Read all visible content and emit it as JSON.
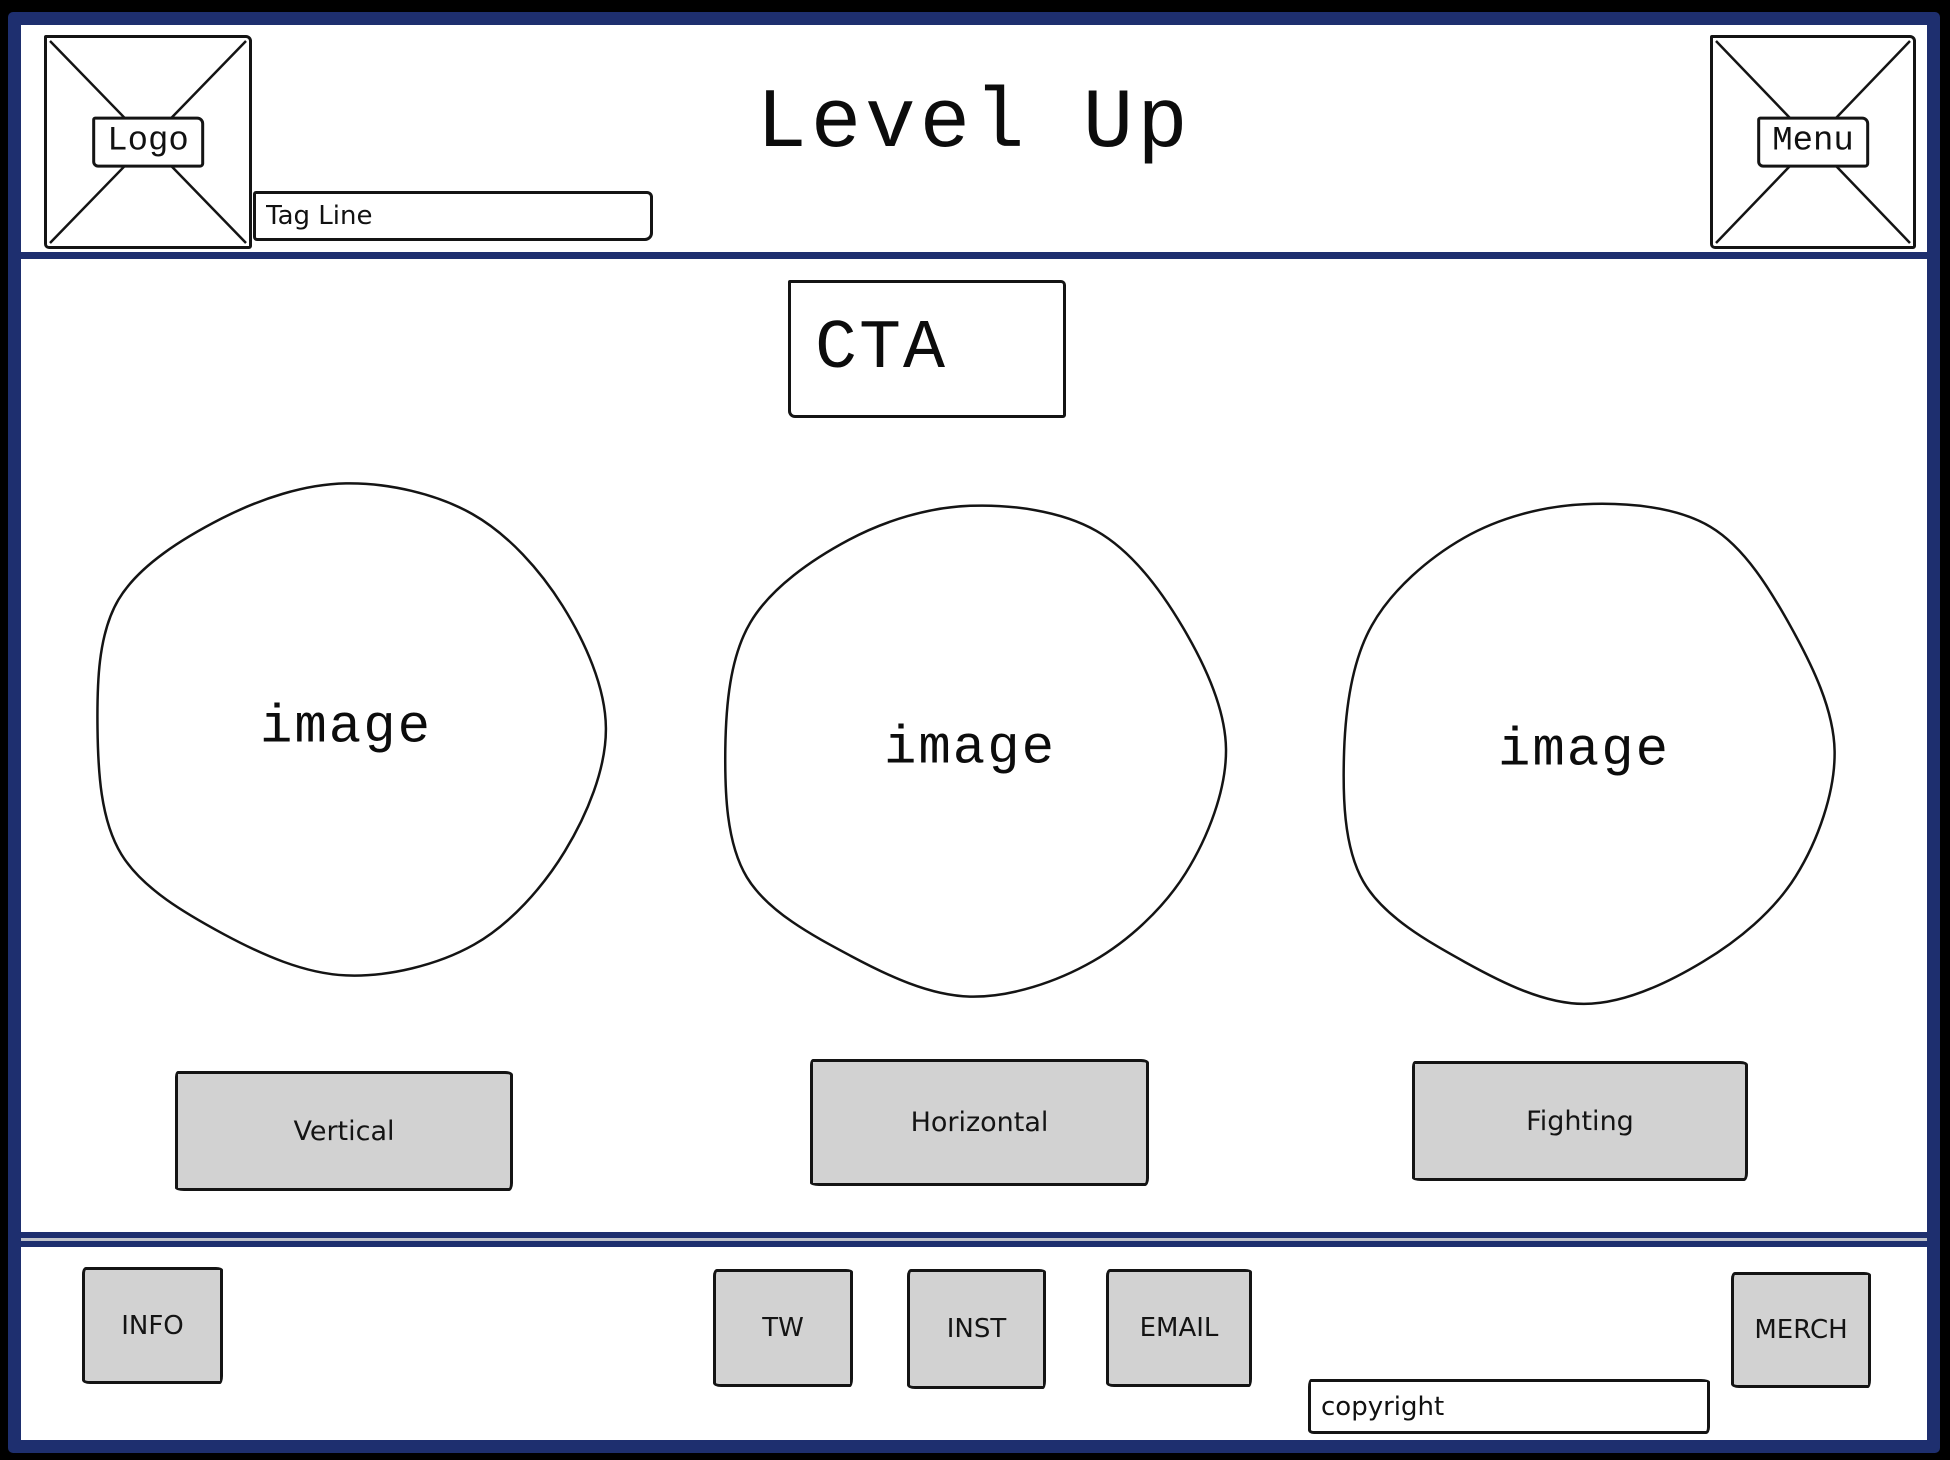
{
  "colors": {
    "frame_navy": "#1e2f6f",
    "outer_black": "#000000",
    "button_gray": "#d2d2d2",
    "divider_gray": "#bfc2ca"
  },
  "header": {
    "logo_label": "Logo",
    "tagline_placeholder": "Tag Line",
    "title": "Level Up",
    "menu_label": "Menu"
  },
  "main": {
    "cta_label": "CTA",
    "cards": [
      {
        "image_label": "image",
        "button_label": "Vertical"
      },
      {
        "image_label": "image",
        "button_label": "Horizontal"
      },
      {
        "image_label": "image",
        "button_label": "Fighting"
      }
    ]
  },
  "footer": {
    "buttons": [
      {
        "label": "INFO"
      },
      {
        "label": "TW"
      },
      {
        "label": "INST"
      },
      {
        "label": "EMAIL"
      },
      {
        "label": "MERCH"
      }
    ],
    "copyright_label": "copyright"
  }
}
